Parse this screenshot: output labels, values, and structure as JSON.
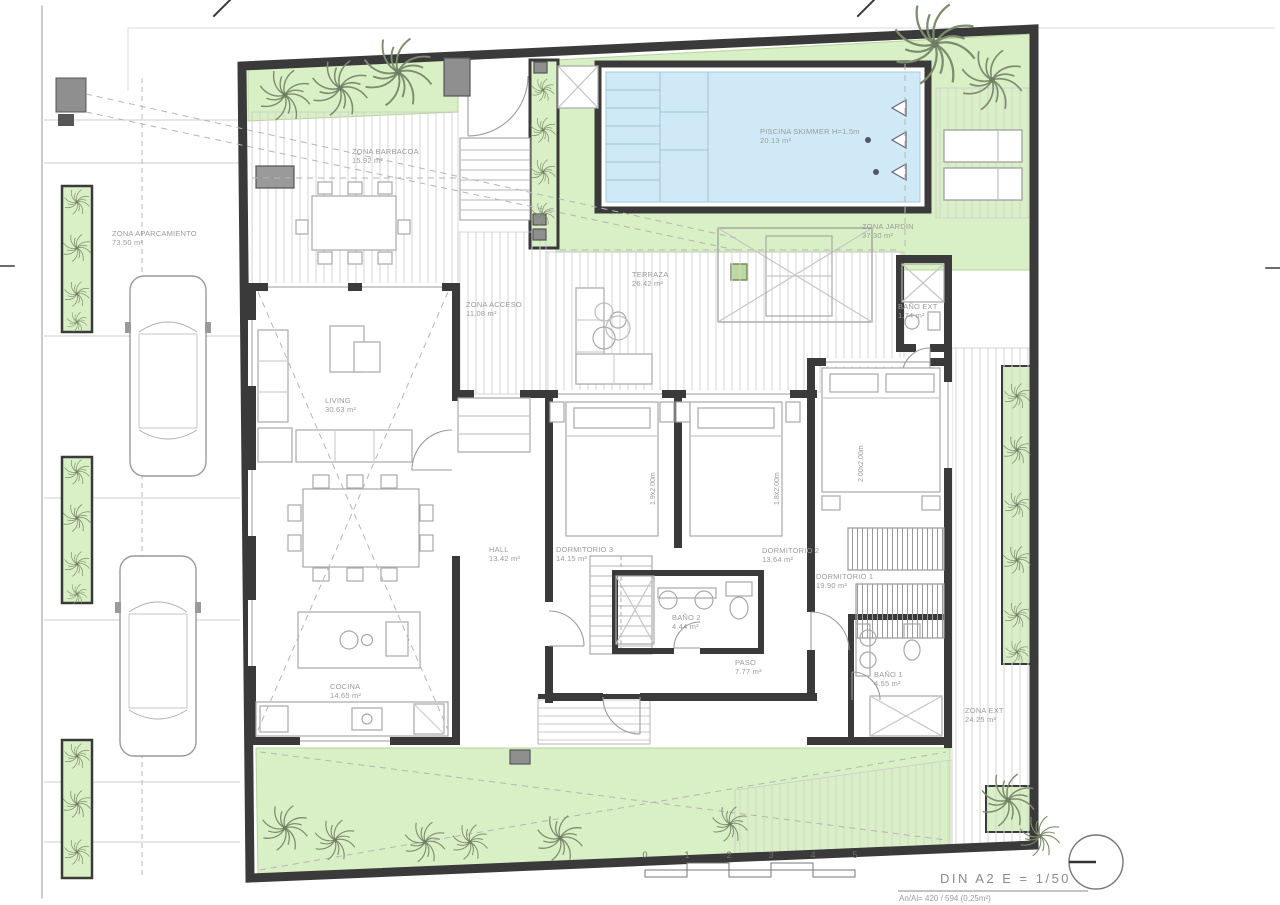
{
  "title_block": {
    "format": "DIN A2  E = 1/50",
    "sheet": "An/Al= 420 / 594 (0.25m²)"
  },
  "scale_bar": {
    "ticks": [
      "0",
      "1",
      "2",
      "3",
      "4",
      "5"
    ]
  },
  "rooms": [
    {
      "name": "ZONA APARCAMIENTO",
      "area": "73.50 m²"
    },
    {
      "name": "ZONA BARBACOA",
      "area": "15.92 m²"
    },
    {
      "name": "PISCINA SKIMMER H=1.5m",
      "area": "20.13 m²"
    },
    {
      "name": "ZONA JARDIN",
      "area": "37.30 m²"
    },
    {
      "name": "TERRAZA",
      "area": "26.42 m²"
    },
    {
      "name": "ZONA ACCESO",
      "area": "11.08 m²"
    },
    {
      "name": "BAÑO EXT",
      "area": "1.74 m²"
    },
    {
      "name": "LIVING",
      "area": "30.63 m²"
    },
    {
      "name": "HALL",
      "area": "13.42 m²"
    },
    {
      "name": "DORMITORIO 3",
      "area": "14.15 m²"
    },
    {
      "name": "DORMITORIO 2",
      "area": "13.64 m²"
    },
    {
      "name": "DORMITORIO 1",
      "area": "19.90 m²"
    },
    {
      "name": "BAÑO 2",
      "area": "4.44 m²"
    },
    {
      "name": "PASO",
      "area": "7.77 m²"
    },
    {
      "name": "BAÑO 1",
      "area": "4.55 m²"
    },
    {
      "name": "COCINA",
      "area": "14.65 m²"
    },
    {
      "name": "ZONA EXT",
      "area": "24.25 m²"
    }
  ],
  "bed_dimensions": [
    "1.9x2.00m",
    "1.8x2.00m",
    "2.00x2.00m"
  ],
  "colors": {
    "wall": "#3a3a3a",
    "garden_green": "#d9efc5",
    "pool_blue": "#cfeaf6"
  }
}
